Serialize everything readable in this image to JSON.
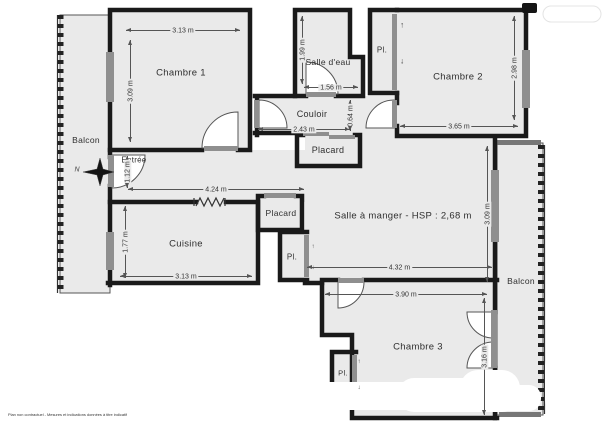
{
  "plan": {
    "disclaimer": "Plan non contractuel - Mesures et indications données à titre indicatif",
    "compass_north": "N",
    "colors": {
      "room_fill": "#eaeaea",
      "wall": "#1a1a1a",
      "window": "#8f8f8f",
      "dimension": "#555555"
    }
  },
  "rooms": [
    {
      "id": "chambre-1",
      "label": "Chambre 1",
      "dim_width": "3.13 m",
      "dim_height": "3.09 m"
    },
    {
      "id": "salle-d-eau",
      "label": "Salle d'eau",
      "dim_width": "1.56 m",
      "dim_height": "1.99 m"
    },
    {
      "id": "chambre-2",
      "label": "Chambre 2",
      "dim_width": "3.65 m",
      "dim_height": "2.98 m"
    },
    {
      "id": "couloir",
      "label": "Couloir",
      "dim_width": "2.43 m",
      "dim_height": "0.64 m"
    },
    {
      "id": "entree",
      "label": "Entrée",
      "dim_height": "1.12 m"
    },
    {
      "id": "degagement",
      "dim_width": "4.24 m"
    },
    {
      "id": "cuisine",
      "label": "Cuisine",
      "dim_width": "3.13 m",
      "dim_height": "1.77 m"
    },
    {
      "id": "salle-a-manger",
      "label": "Salle à manger - HSP : 2,68 m",
      "dim_width": "4.32 m",
      "dim_height": "3.09 m"
    },
    {
      "id": "chambre-3",
      "label": "Chambre 3",
      "dim_width": "3.90 m",
      "dim_height": "3.16 m"
    },
    {
      "id": "balcon-gauche",
      "label": "Balcon"
    },
    {
      "id": "balcon-droit",
      "label": "Balcon"
    }
  ],
  "closets": [
    {
      "id": "pl-chambre-2",
      "label": "Pl.",
      "arrow_up": "↑",
      "arrow_down": "↓"
    },
    {
      "id": "placard-couloir",
      "label": "Placard"
    },
    {
      "id": "placard-cuisine",
      "label": "Placard"
    },
    {
      "id": "pl-salle-a-manger",
      "label": "Pl.",
      "arrow_up": "↑",
      "arrow_down": "↓"
    },
    {
      "id": "pl-chambre-3",
      "label": "Pl.",
      "arrow_up": "↑",
      "arrow_down": "↓"
    }
  ]
}
